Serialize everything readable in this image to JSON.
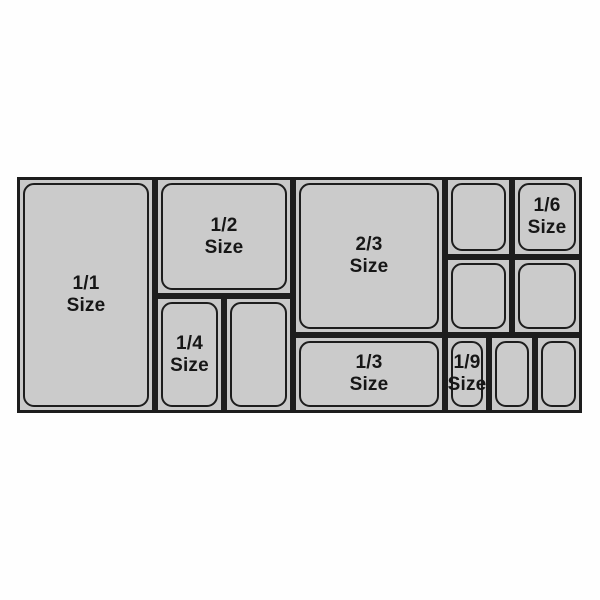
{
  "pans": {
    "p1_1": {
      "fraction": "1/1",
      "word": "Size"
    },
    "p1_2": {
      "fraction": "1/2",
      "word": "Size"
    },
    "p1_4": {
      "fraction": "1/4",
      "word": "Size"
    },
    "p2_3": {
      "fraction": "2/3",
      "word": "Size"
    },
    "p1_3": {
      "fraction": "1/3",
      "word": "Size"
    },
    "p1_6": {
      "fraction": "1/6",
      "word": "Size"
    },
    "p1_9": {
      "fraction": "1/9",
      "word": "Size"
    }
  },
  "colors": {
    "pan_fill": "#cbcbcb",
    "cell_fill": "#c9c9c9",
    "outline": "#1d1d1d",
    "label_text": "#161616",
    "page_background": "#fefefe"
  }
}
